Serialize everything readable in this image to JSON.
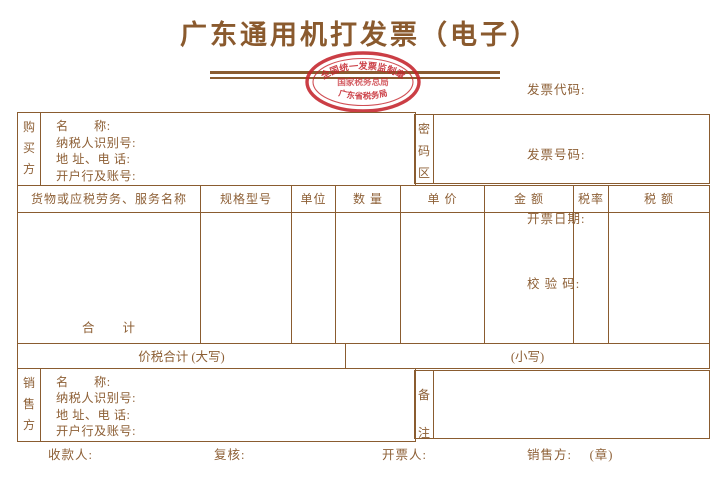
{
  "title": "广东通用机打发票（电子）",
  "invoice_info": {
    "code_label": "发票代码:",
    "number_label": "发票号码:",
    "date_label": "开票日期:",
    "checksum_label": "校 验 码:"
  },
  "stamp": {
    "arc_top": "全国统一发票监制章",
    "middle": "国家税务总局",
    "arc_bottom": "广东省税务局"
  },
  "buyer": {
    "side_label": "购买方",
    "name_label": "名　　称:",
    "tax_id_label": "纳税人识别号:",
    "address_label": "地 址、电 话:",
    "bank_label": "开户行及账号:"
  },
  "password_area": {
    "side_label": "密码区"
  },
  "items": {
    "headers": [
      "货物或应税劳务、服务名称",
      "规格型号",
      "单位",
      "数 量",
      "单 价",
      "金 额",
      "税率",
      "税 额"
    ],
    "total_label": "合　　计"
  },
  "totals": {
    "in_words_label": "价税合计 (大写)",
    "in_figures_label": "(小写)"
  },
  "seller": {
    "side_label": "销售方",
    "name_label": "名　　称:",
    "tax_id_label": "纳税人识别号:",
    "address_label": "地 址、电 话:",
    "bank_label": "开户行及账号:"
  },
  "remarks": {
    "side_label": "备注"
  },
  "footer": {
    "payee_label": "收款人:",
    "reviewer_label": "复核:",
    "drawer_label": "开票人:",
    "seller_seal_label": "销售方:　 (章)"
  },
  "colors": {
    "line": "#8a5c30",
    "text": "#8d5f35",
    "stamp_red": "#c4232b"
  }
}
